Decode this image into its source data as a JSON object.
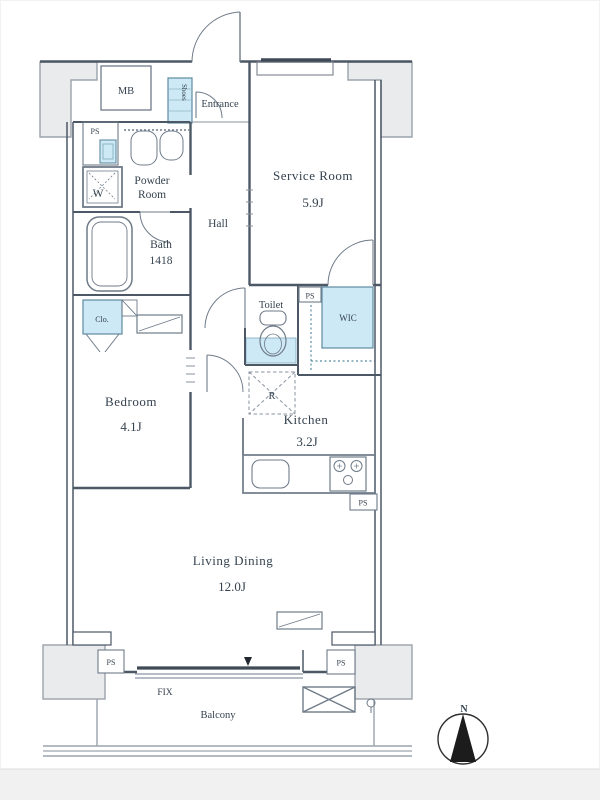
{
  "plan": {
    "type": "apartment-floor-plan",
    "rooms": {
      "service_room": {
        "name": "Service Room",
        "size": "5.9J"
      },
      "bedroom": {
        "name": "Bedroom",
        "size": "4.1J"
      },
      "kitchen": {
        "name": "Kitchen",
        "size": "3.2J"
      },
      "living_dining": {
        "name": "Living Dining",
        "size": "12.0J"
      },
      "bath": {
        "name": "Bath",
        "size": "1418"
      },
      "powder_room": {
        "line1": "Powder",
        "line2": "Room"
      },
      "hall": {
        "name": "Hall"
      },
      "toilet": {
        "name": "Toilet"
      },
      "entrance": {
        "name": "Entrance"
      },
      "balcony": {
        "name": "Balcony"
      }
    },
    "storage": {
      "wic": "WIC",
      "closet": "Clo.",
      "shoes": "Shoes",
      "refrigerator": "R"
    },
    "utility": {
      "meter_box": "MB",
      "pipe_space": "PS",
      "washer": "W",
      "fix_window": "FIX"
    },
    "compass": {
      "north": "N"
    },
    "colors": {
      "wall": "#4d5866",
      "storage_fill": "#cde9f5",
      "storage_stroke": "#5e8ba1",
      "pillar_fill": "#e9ebed",
      "text": "#35424f"
    }
  }
}
